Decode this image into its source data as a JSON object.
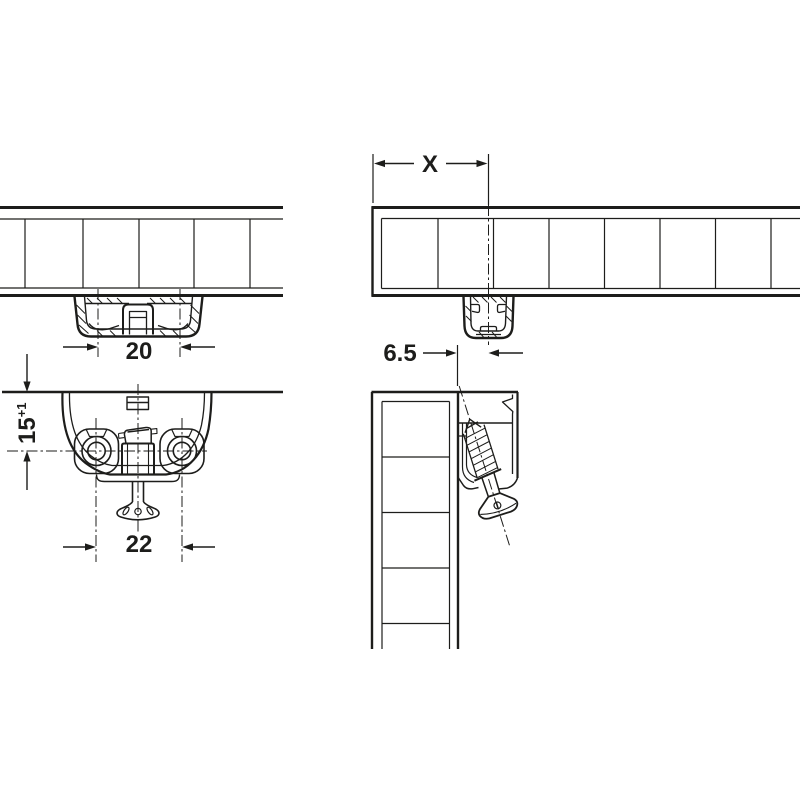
{
  "colors": {
    "line": "#1d1d1b",
    "background": "#ffffff"
  },
  "dimensions": {
    "housing_width": "20",
    "drilling_depth": "15",
    "drilling_depth_tolerance": "+1",
    "hole_spacing": "22",
    "edge_distance": "X",
    "clip_center_offset": "6.5"
  }
}
